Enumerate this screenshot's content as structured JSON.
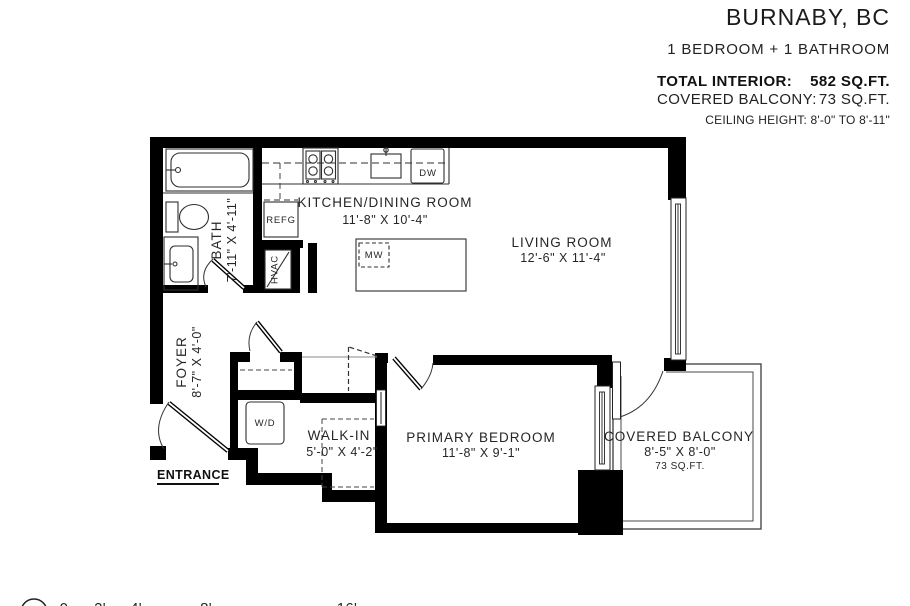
{
  "header": {
    "city": "BURNABY, BC",
    "unit_type": "1 BEDROOM + 1 BATHROOM",
    "total_interior_label": "TOTAL INTERIOR:",
    "total_interior_value": "582 SQ.FT.",
    "balcony_label": "COVERED BALCONY:",
    "balcony_value": "73 SQ.FT.",
    "ceiling_height": "CEILING HEIGHT: 8'-0\" TO 8'-11\""
  },
  "rooms": {
    "kitchen": {
      "name": "KITCHEN/DINING ROOM",
      "dims": "11'-8\" X 10'-4\""
    },
    "living": {
      "name": "LIVING ROOM",
      "dims": "12'-6\" X 11'-4\""
    },
    "bath": {
      "name": "BATH",
      "dims": "7'-11\" X 4'-11\""
    },
    "foyer": {
      "name": "FOYER",
      "dims": "8'-7\" X 4'-0\""
    },
    "walkin": {
      "name": "WALK-IN",
      "dims": "5'-0\" X 4'-2\""
    },
    "bedroom": {
      "name": "PRIMARY BEDROOM",
      "dims": "11'-8\" X 9'-1\""
    },
    "balcony": {
      "name": "COVERED BALCONY",
      "dims": "8'-5\" X 8'-0\"",
      "area": "73 SQ.FT."
    }
  },
  "fixtures": {
    "refrigerator": "REFG",
    "hvac": "HVAC",
    "microwave": "MW",
    "dishwasher": "DW",
    "washer_dryer": "W/D"
  },
  "entrance_label": "ENTRANCE",
  "scale": {
    "labels": [
      "0",
      "2'",
      "4'",
      "8'",
      "16'"
    ]
  },
  "colors": {
    "wall": "#000000",
    "background": "#ffffff",
    "thin_line": "#4a4a4a",
    "text": "#222222"
  }
}
